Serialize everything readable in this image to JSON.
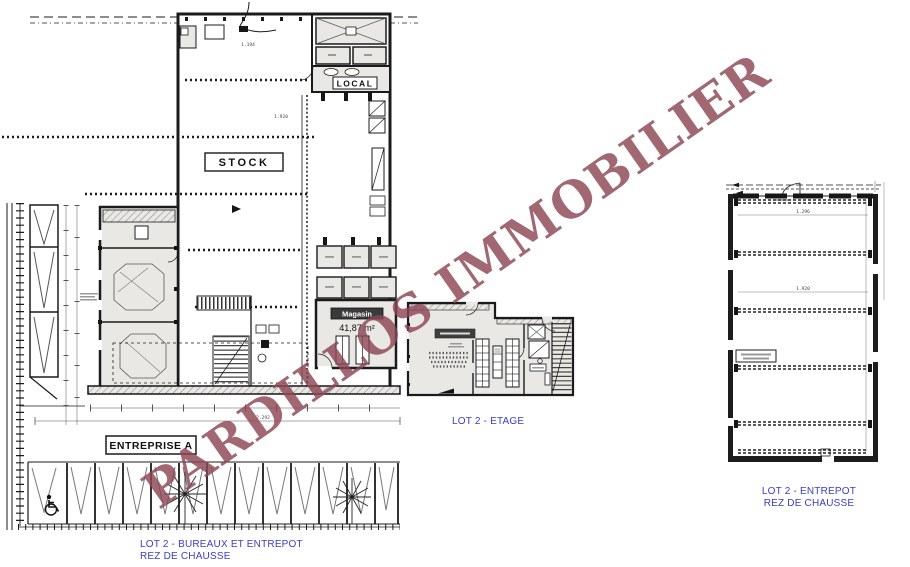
{
  "watermark": {
    "text": "PARDILLOS IMMOBILIER",
    "color": "#8c4554"
  },
  "captions": {
    "color": "#3c3ccc",
    "main_line1": "LOT 2 - BUREAUX ET ENTREPOT",
    "main_line2": "REZ DE CHAUSSE",
    "etage": "LOT 2 - ETAGE",
    "entrepot_line1": "LOT 2 - ENTREPOT",
    "entrepot_line2": "REZ DE CHAUSSE"
  },
  "main_plan": {
    "room_labels": {
      "stock": "STOCK",
      "local": "LOCAL",
      "magasin": "Magasin",
      "magasin_area": "41,87 m²"
    },
    "site_label": "ENTREPRISE A",
    "dimensions": {
      "top_bay": "1.194",
      "mid_bay": "1.920",
      "overall": "2.292"
    }
  },
  "entrepot_plan": {
    "dimensions": {
      "upper_bay": "1.296",
      "lower_bay": "1.920"
    }
  }
}
